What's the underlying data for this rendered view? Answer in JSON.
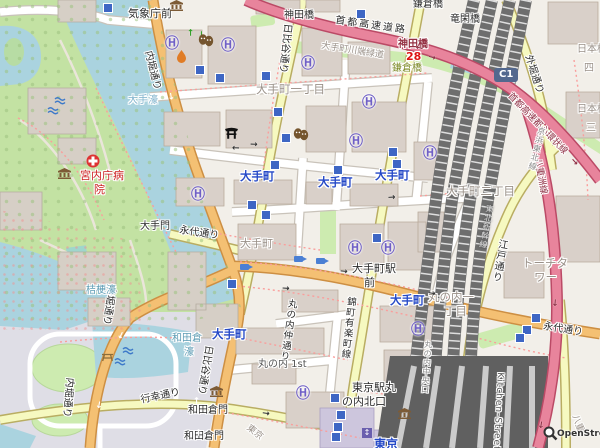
{
  "map": {
    "attribution": "OpenStreetMap",
    "place_labels": {
      "kishocho_mae": "気象庁前",
      "otemachi_1chome": "大手町一丁目",
      "otemachi_2chome": "大手町二丁目",
      "otemachi": "大手町",
      "marunouchi_1chome_l1": "丸の内一",
      "marunouchi_1chome_l2": "丁目",
      "marunouchi_1st": "丸の内 1st",
      "torch_tower_l1": "トーチタ",
      "torch_tower_l2": "ワー",
      "nihonbashi": "日本橋",
      "nihonbashi_4": "四",
      "nihonbashi_3": "三",
      "yaesu": "八重",
      "tokyo_rotated": "東京",
      "otemon": "大手門",
      "wadakuramon": "和田倉門",
      "kandabashi": "神田橋",
      "kamakurabashi": "鎌倉橋",
      "ryukanbashi": "竜閑橋",
      "tokyo_sta_north_l1": "東京駅丸",
      "tokyo_sta_north_l2": "の内北口",
      "otemachi_ekimae_l1": "大手町駅",
      "otemachi_ekimae_l2": "前",
      "hospital_l1": "宮内庁病",
      "hospital_l2": "院"
    },
    "road_labels": {
      "uchibori_dori": "内堀通り",
      "hibiya_dori": "日比谷通り",
      "eitai_dori": "永代通り",
      "gyoko_dori": "行幸通り",
      "edo_dori": "江戸通り",
      "sotobori_dori": "外堀通り",
      "nishikicho_yurakucho": "錦町有楽町線",
      "marunouchi_naka": "丸の内仲通り",
      "marunouchi_chuo": "丸の内中央口",
      "kitchen_street": "Kitchen-Street",
      "shuto_expressway": "首都高速道路",
      "shuto_c1": "首都高速都心環状線",
      "yaesu_line": "八重洲線",
      "kandabashi_exit": "神田橋",
      "kawabata_greenway": "大手町川端緑道"
    },
    "rail_labels": {
      "keihin_tohoku": "京浜東北線",
      "tohoku_shinkansen": "東北新幹線"
    },
    "station_labels": {
      "otemachi": "大手町",
      "tokyo": "東京"
    },
    "water_labels": {
      "otebori": "大手濠",
      "kikyobori": "桔梗濠",
      "wadakura_l1": "和田倉",
      "wadakura_l2": "濠"
    },
    "shields": {
      "c1": "C1",
      "route28": "28"
    },
    "icons": {
      "helipad": "Ⓗ",
      "arrow": "→",
      "elevator": "↕"
    },
    "colors": {
      "water": "#aad3df",
      "park": "#c3e2a3",
      "building": "#d9d0c9",
      "road_primary": "#f4c073",
      "road_secondary": "#f6f9c0",
      "motorway": "#e8849c",
      "rail": "#6e6e6e",
      "subway_entrance": "#3e66c4",
      "helipad": "#6f5fc6",
      "station_text": "#2549c7"
    }
  }
}
